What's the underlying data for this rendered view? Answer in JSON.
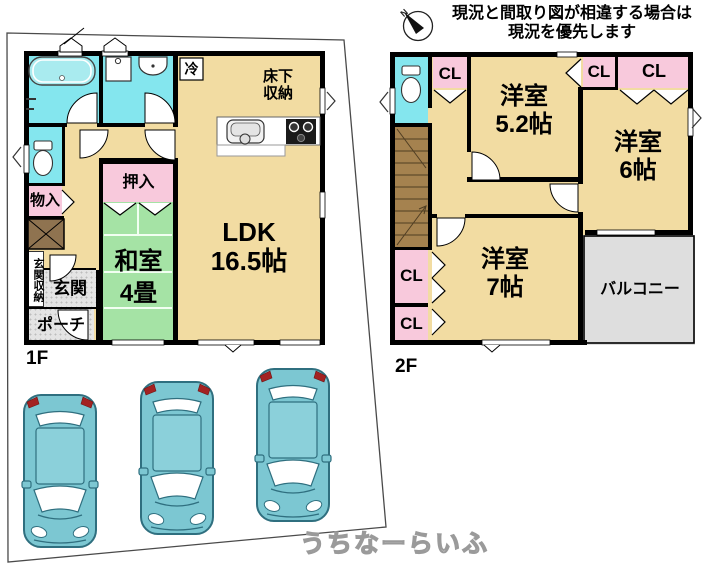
{
  "disclaimer": {
    "line1": "現況と間取り図が相違する場合は",
    "line2": "現況を優先します"
  },
  "compass": {
    "north_label": "N"
  },
  "floor1": {
    "floor_label": "1F",
    "ldk": {
      "name": "LDK",
      "size": "16.5帖"
    },
    "washitsu": {
      "name": "和室",
      "size": "4畳"
    },
    "oshiire": "押入",
    "monoire": "物入",
    "genkan": "玄関",
    "genkan_shuno": "玄関収納",
    "porch": "ポーチ",
    "fridge": "冷",
    "yukashita_line1": "床下",
    "yukashita_line2": "収納"
  },
  "floor2": {
    "floor_label": "2F",
    "yoshitsu_52": {
      "name": "洋室",
      "size": "5.2帖"
    },
    "yoshitsu_6": {
      "name": "洋室",
      "size": "6帖"
    },
    "yoshitsu_7": {
      "name": "洋室",
      "size": "7帖"
    },
    "closet_label": "CL",
    "balcony": "バルコニー"
  },
  "watermark": "うちなーらいふ",
  "colors": {
    "wall": "#000000",
    "room_tan": "#F2DCA2",
    "wet_cyan": "#84E6EE",
    "storage_pink": "#F8C9DC",
    "tatami_green": "#A5E3A5",
    "entry_gray": "#E4E4E4",
    "stairs_brown": "#A5824F",
    "car_teal": "#7CC7D2",
    "taillight_red": "#A32222"
  }
}
